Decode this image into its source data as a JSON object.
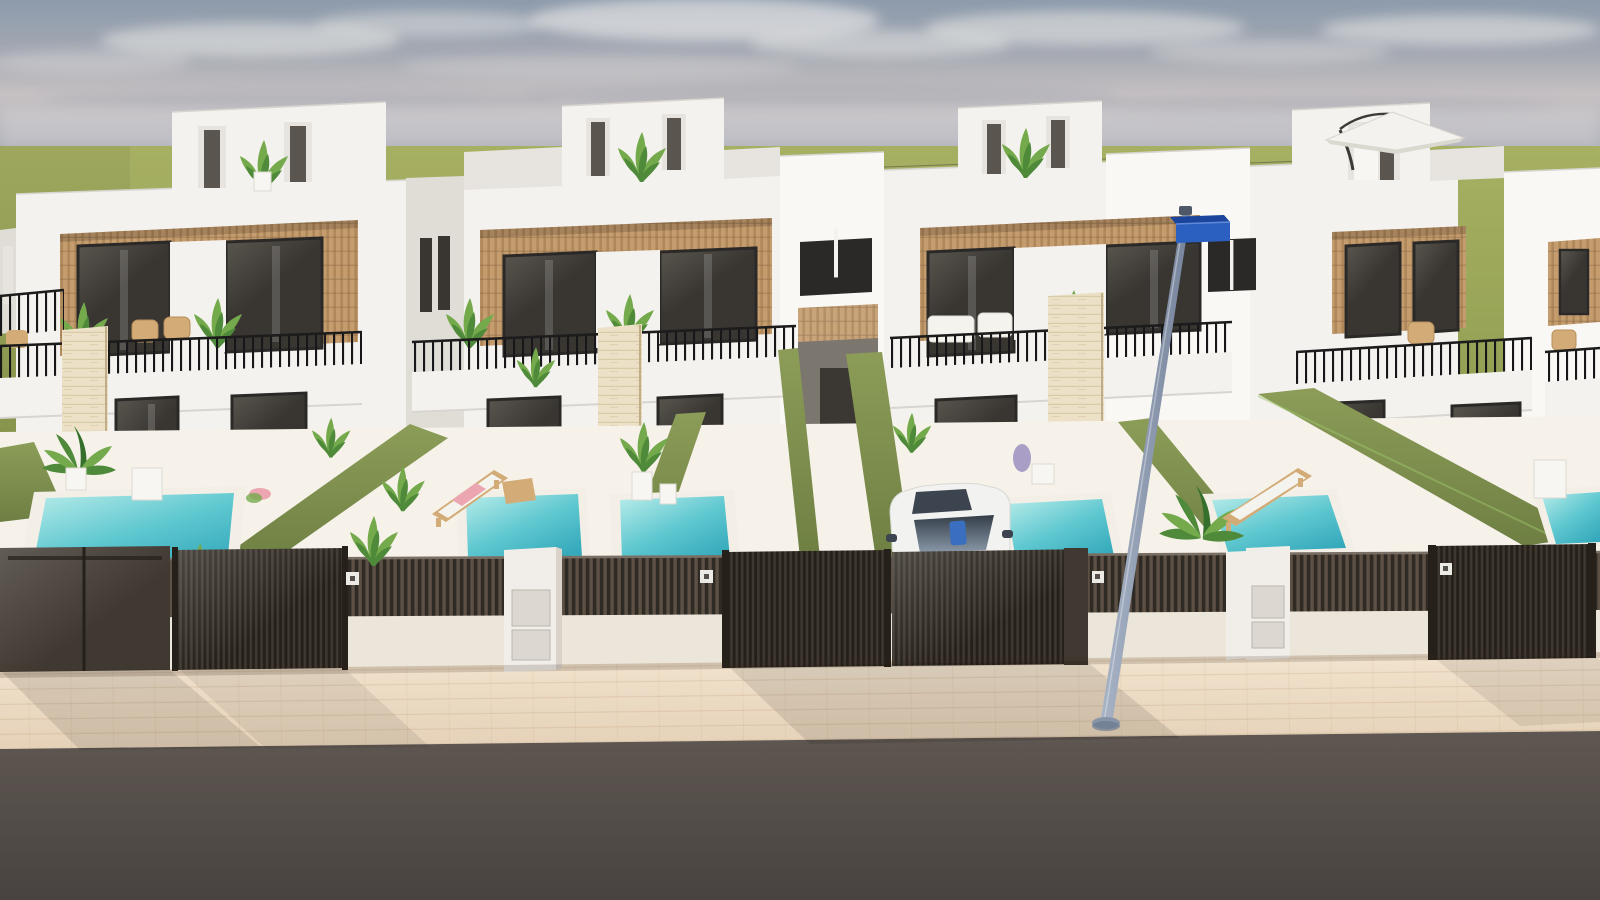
{
  "scene": {
    "description": "3D architectural rendering of a row of modern white two-storey townhouses with rooftop penthouses, wood-slat balcony panels, private plunge pools, olive hedge dividers, dark slatted street fences and gates, white utility pillars, a parked white car, a street lamp with a blue street-name sign, a white roof parasol, a beige tiled sidewalk and a dark asphalt road in front, under a hazy blue-grey sky over open green fields.",
    "houses": 4,
    "pools": 6,
    "gates": 5,
    "utility_pillars": 2,
    "cars": 1,
    "street_lamps": 1,
    "objects": [
      "sky",
      "clouds",
      "grass-field",
      "townhouse-row",
      "penthouses",
      "roof-parasol",
      "balconies",
      "railings",
      "stone-columns",
      "hedges",
      "pools",
      "sun-loungers",
      "plants",
      "white-car",
      "fence",
      "gates",
      "mailbox-pillars",
      "number-plaques",
      "sidewalk",
      "road",
      "street-lamp",
      "street-sign"
    ]
  },
  "palette": {
    "sky-top": "#8d9bac",
    "sky-mid": "#a4a8b2",
    "sky-haze": "#c6c1c3",
    "sky-low": "#a9aab6",
    "cloud": "#f0efec",
    "cloud-streak": "#6f7e93",
    "grass-1": "#a7b062",
    "grass-2": "#8b9a4e",
    "wall-white": "#f4f2ee",
    "wall-lit": "#f9f8f5",
    "wall-shade": "#e7e4df",
    "wall-dim": "#e0ddd7",
    "edge-line": "#d8d5d0",
    "wood-1": "#c59c6e",
    "wood-2": "#ae875b",
    "wood-dk": "#8f6f4b",
    "stone-1": "#ece1c6",
    "stone-2": "#d9cba6",
    "glass-1": "#393632",
    "glass-2": "#5a564f",
    "frame-dark": "#2b2927",
    "mullion": "#55514b",
    "hedge-1": "#8c9d58",
    "hedge-2": "#6e7f43",
    "pool-1": "#b9ecea",
    "pool-2": "#5fc8d0",
    "pool-3": "#36aabc",
    "coping": "#f3efe7",
    "fence-dark": "#2f2a24",
    "fence-slat": "#5d5044",
    "fence-base": "#ece6da",
    "gate-dark": "#403931",
    "fence-frame": "#252019",
    "box-white": "#f1eee9",
    "box-side": "#d9d3ca",
    "box-door": "#dcd7d0",
    "plaque": "#eceae4",
    "walk-1": "#f2e4cf",
    "walk-2": "#e5d1b8",
    "tile-line": "#b08a5e",
    "road-1": "#5f5751",
    "road-2": "#484340",
    "pole-1": "#aab5c7",
    "pole-2": "#75839b",
    "sign-front": "#2b60c0",
    "sign-top": "#1b459c",
    "car-body": "#f2f3f1",
    "car-shade": "#d9dad6",
    "car-glass": "#333d47",
    "car-glass2": "#8a99a9",
    "car-blue": "#3a6fc0",
    "car-dark": "#3c4450",
    "leaf-1": "#4e8a39",
    "leaf-2": "#74aa4b",
    "leaf-3": "#346f2c",
    "leaf-pale": "#9cc46a",
    "wicker": "#d3ab76",
    "cushion": "#f5f3ee",
    "towel-pink": "#eba6b2",
    "lavender": "#9a8fc0",
    "parasol": "#f3f2ee",
    "parasol-under": "#dbd8d0",
    "parasol-pole": "#3c3a37"
  }
}
